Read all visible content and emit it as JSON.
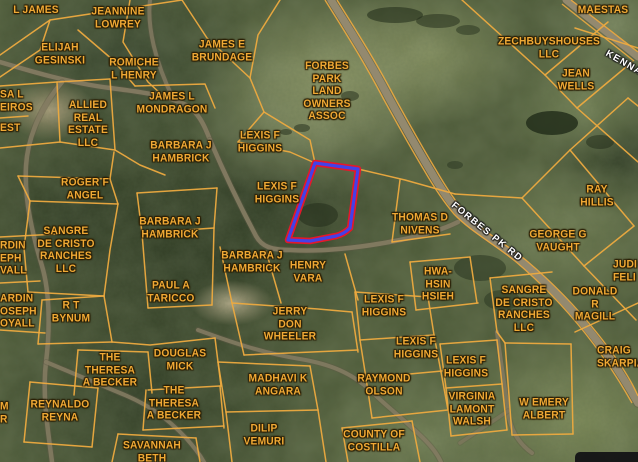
{
  "map": {
    "type": "county-parcel-satellite-map",
    "colors": {
      "parcel_line": "#edaa3f",
      "owner_label": "#f0a935",
      "road_label": "#ffffff",
      "selection_outer": "#e5182b",
      "selection_inner": "#4341e8",
      "main_road": "#93896f",
      "dirt_road": "#857c63"
    },
    "selected_parcel": {
      "path": "M315,163 L358,169 L350,228 Q344,234 336,236 L310,241 L288,240 Z",
      "outer_color": "#e5182b",
      "outer_width": 6.5,
      "inner_color": "#4341e8",
      "inner_width": 3.2
    },
    "parcel_labels": [
      {
        "id": "l-james",
        "t": "L JAMES",
        "x": 36,
        "y": 10
      },
      {
        "id": "jeannine-lowrey",
        "t": "JEANNINE\nLOWREY",
        "x": 118,
        "y": 18
      },
      {
        "id": "elijah-gesinski",
        "t": "ELIJAH\nGESINSKI",
        "x": 60,
        "y": 54
      },
      {
        "id": "romiche-l-henry",
        "t": "ROMICHE\nL HENRY",
        "x": 134,
        "y": 69
      },
      {
        "id": "james-e-brundage",
        "t": "JAMES E\nBRUNDAGE",
        "x": 222,
        "y": 51
      },
      {
        "id": "forbes-park-land-owners-assoc",
        "t": "FORBES\nPARK\nLAND\nOWNERS\nASSOC",
        "x": 327,
        "y": 91
      },
      {
        "id": "maestas",
        "t": "MAESTAS",
        "x": 603,
        "y": 10
      },
      {
        "id": "zechbuyshouses-llc",
        "t": "ZECHBUYSHOUSES\nLLC",
        "x": 549,
        "y": 48
      },
      {
        "id": "jean-wells",
        "t": "JEAN\nWELLS",
        "x": 576,
        "y": 80
      },
      {
        "id": "james-l-mondragon",
        "t": "JAMES L\nMONDRAGON",
        "x": 172,
        "y": 103
      },
      {
        "id": "allied-real-estate-llc",
        "t": "ALLIED\nREAL\nESTATE\nLLC",
        "x": 88,
        "y": 124
      },
      {
        "id": "fragment-sa-l-eiros",
        "t": "SA L\nEIROS",
        "x": 0,
        "y": 101,
        "a": "l"
      },
      {
        "id": "fragment-est",
        "t": "EST",
        "x": 0,
        "y": 128,
        "a": "l"
      },
      {
        "id": "barbara-j-hambrick-1",
        "t": "BARBARA J\nHAMBRICK",
        "x": 181,
        "y": 152
      },
      {
        "id": "lexis-f-higgins-1",
        "t": "LEXIS F\nHIGGINS",
        "x": 260,
        "y": 142
      },
      {
        "id": "lexis-f-higgins-2",
        "t": "LEXIS F\nHIGGINS",
        "x": 277,
        "y": 193
      },
      {
        "id": "roger-f-angel",
        "t": "ROGER F\nANGEL",
        "x": 85,
        "y": 189
      },
      {
        "id": "sangre-de-cristo-ranches-llc-1",
        "t": "SANGRE\nDE CRISTO\nRANCHES\nLLC",
        "x": 66,
        "y": 250
      },
      {
        "id": "barbara-j-hambrick-2",
        "t": "BARBARA J\nHAMBRICK",
        "x": 170,
        "y": 228
      },
      {
        "id": "paul-a-taricco",
        "t": "PAUL A\nTARICCO",
        "x": 171,
        "y": 292
      },
      {
        "id": "r-t-bynum",
        "t": "R T\nBYNUM",
        "x": 71,
        "y": 312
      },
      {
        "id": "fragment-rdin-eph-vall",
        "t": "RDIN\nEPH\nVALL",
        "x": 0,
        "y": 258,
        "a": "l"
      },
      {
        "id": "fragment-ardin-oseph-oyall",
        "t": "ARDIN\nOSEPH\nOYALL",
        "x": 0,
        "y": 311,
        "a": "l"
      },
      {
        "id": "thomas-d-nivens",
        "t": "THOMAS D\nNIVENS",
        "x": 420,
        "y": 224
      },
      {
        "id": "henry-vara",
        "t": "HENRY\nVARA",
        "x": 308,
        "y": 272
      },
      {
        "id": "barbara-j-hambrick-3",
        "t": "BARBARA J\nHAMBRICK",
        "x": 252,
        "y": 262
      },
      {
        "id": "hwa-hsin-hsieh",
        "t": "HWA-\nHSIN\nHSIEH",
        "x": 438,
        "y": 284
      },
      {
        "id": "ray-hillis",
        "t": "RAY\nHILLIS",
        "x": 597,
        "y": 196
      },
      {
        "id": "george-g-vaught",
        "t": "GEORGE G\nVAUGHT",
        "x": 558,
        "y": 241
      },
      {
        "id": "sangre-de-cristo-ranches-llc-2",
        "t": "SANGRE\nDE CRISTO\nRANCHES\nLLC",
        "x": 524,
        "y": 309
      },
      {
        "id": "donald-r-magill",
        "t": "DONALD R\nMAGILL",
        "x": 595,
        "y": 304
      },
      {
        "id": "fragment-judi-feli",
        "t": "JUDI\nFELI",
        "x": 613,
        "y": 271,
        "a": "l"
      },
      {
        "id": "craig-skarpia",
        "t": "CRAIG\nSKARPIA",
        "x": 597,
        "y": 357,
        "a": "l"
      },
      {
        "id": "jerry-don-wheeler",
        "t": "JERRY\nDON\nWHEELER",
        "x": 290,
        "y": 324
      },
      {
        "id": "lexis-f-higgins-3",
        "t": "LEXIS F\nHIGGINS",
        "x": 384,
        "y": 306
      },
      {
        "id": "lexis-f-higgins-4",
        "t": "LEXIS F\nHIGGINS",
        "x": 416,
        "y": 348
      },
      {
        "id": "madhavi-k-angara",
        "t": "MADHAVI K\nANGARA",
        "x": 278,
        "y": 385
      },
      {
        "id": "raymond-olson",
        "t": "RAYMOND\nOLSON",
        "x": 384,
        "y": 385
      },
      {
        "id": "dilip-vemuri",
        "t": "DILIP\nVEMURI",
        "x": 264,
        "y": 435
      },
      {
        "id": "county-of-costilla",
        "t": "COUNTY OF\nCOSTILLA",
        "x": 374,
        "y": 441
      },
      {
        "id": "the-theresa-a-becker-1",
        "t": "THE\nTHERESA\nA BECKER",
        "x": 110,
        "y": 370
      },
      {
        "id": "douglas-mick",
        "t": "DOUGLAS\nMICK",
        "x": 180,
        "y": 360
      },
      {
        "id": "the-theresa-a-becker-2",
        "t": "THE\nTHERESA\nA BECKER",
        "x": 174,
        "y": 403
      },
      {
        "id": "reynaldo-reyna",
        "t": "REYNALDO\nREYNA",
        "x": 60,
        "y": 411
      },
      {
        "id": "savannah-beth",
        "t": "SAVANNAH\nBETH",
        "x": 152,
        "y": 452
      },
      {
        "id": "lexis-f-higgins-5",
        "t": "LEXIS F\nHIGGINS",
        "x": 466,
        "y": 367
      },
      {
        "id": "virginia-lamont-walsh",
        "t": "VIRGINIA\nLAMONT\nWALSH",
        "x": 472,
        "y": 409
      },
      {
        "id": "w-emery-albert",
        "t": "W EMERY\nALBERT",
        "x": 544,
        "y": 409
      },
      {
        "id": "fragment-m-r",
        "t": "M\nR",
        "x": 0,
        "y": 413,
        "a": "l"
      }
    ],
    "road_labels": [
      {
        "id": "forbes-pk-rd",
        "t": "FORBES PK RD",
        "x": 487,
        "y": 232,
        "angle": 39
      },
      {
        "id": "kenna-rd",
        "t": "KENNA",
        "x": 624,
        "y": 63,
        "angle": 30
      }
    ],
    "roads": [
      {
        "d": "M331,0 C346,24 368,58 389,98 C405,127 416,147 430,170 C441,189 449,201 460,214 C476,231 500,244 521,261 C547,283 571,308 591,333 C611,358 625,380 638,403",
        "w": 7.5,
        "c": "#93896f",
        "o": 1
      },
      {
        "d": "M566,0 L638,57",
        "w": 7,
        "c": "#93896f",
        "o": 1
      },
      {
        "d": "M0,62 C30,71 70,83 110,88 C142,92 166,95 186,105 C198,112 204,124 210,140",
        "w": 4.5,
        "c": "#857c63",
        "o": 0.9
      },
      {
        "d": "M210,140 C222,168 240,206 256,236 C262,247 272,250 290,250 C320,252 360,248 400,240 C420,236 442,230 458,222",
        "w": 4.5,
        "c": "#857c63",
        "o": 0.9
      },
      {
        "d": "M62,82 C45,102 28,132 26,166 C24,200 33,236 42,266 C50,293 50,330 46,362 C42,396 48,430 52,462",
        "w": 4.5,
        "c": "#857c63",
        "o": 0.85
      },
      {
        "d": "M46,362 C72,373 96,383 120,393 C150,405 168,419 186,438 C194,447 200,455 204,462",
        "w": 4,
        "c": "#857c63",
        "o": 0.85
      },
      {
        "d": "M198,330 C228,341 262,353 300,359 C330,364 352,373 371,391 C386,406 406,421 424,439 C431,446 437,453 441,462",
        "w": 4,
        "c": "#857c63",
        "o": 0.85
      },
      {
        "d": "M497,332 C500,357 505,387 508,411 C510,429 518,443 532,453",
        "w": 4,
        "c": "#857c63",
        "o": 0.8
      },
      {
        "d": "M508,411 C492,422 476,432 460,443",
        "w": 3.5,
        "c": "#857c63",
        "o": 0.6
      },
      {
        "d": "M150,0 C147,26 155,62 173,98",
        "w": 4,
        "c": "#857c63",
        "o": 0.8
      }
    ],
    "road_casings": [
      {
        "d": "M325,0 C340,24 362,58 383,98 C399,127 410,147 424,170 C435,189 443,201 454,214 C470,231 494,244 515,261 C541,283 565,308 585,333 C605,358 619,380 632,403"
      },
      {
        "d": "M337,0 C352,24 374,58 395,98 C411,127 422,147 436,170 C447,189 455,201 466,214 C482,231 506,244 527,261 C553,283 577,308 597,333 C617,358 631,380 638,396"
      },
      {
        "d": "M562,4 L634,61"
      },
      {
        "d": "M571,0 L638,52"
      }
    ],
    "parcel_lines": [
      "0,55 50,20 182,0",
      "50,20 40,50 0,77",
      "78,30 113,60 135,86",
      "130,0 123,42 148,82 162,95",
      "182,0 207,38 250,78",
      "280,0 258,35 250,78",
      "250,78 264,112 238,142",
      "0,86 57,82 110,79",
      "57,82 60,142",
      "110,79 115,150",
      "0,148 60,142 115,150",
      "135,86 205,84 215,108",
      "115,150 140,165 165,175",
      "0,118 28,116",
      "238,142 290,152 315,163",
      "264,112 310,140 315,163",
      "358,169 405,180 455,194",
      "455,194 522,198",
      "137,193 217,188",
      "137,193 142,233",
      "217,188 214,228",
      "142,233 214,228",
      "18,176 110,179",
      "18,176 30,201",
      "30,201 118,204",
      "110,179 114,152",
      "110,179 118,204",
      "30,201 24,248 28,292",
      "28,292 104,296",
      "118,204 110,250 104,296",
      "142,233 148,308",
      "214,228 212,305",
      "148,308 212,305",
      "0,237 58,234",
      "0,283 40,281",
      "0,330 45,333",
      "42,300 104,296",
      "104,296 112,342",
      "42,300 38,344",
      "38,344 112,342",
      "112,342 150,345 215,338",
      "215,338 221,386",
      "78,350 148,352",
      "78,350 74,395",
      "148,352 152,393",
      "148,390 220,386",
      "220,386 224,428",
      "146,390 143,430",
      "143,430 224,426",
      "30,382 98,388",
      "30,382 24,442",
      "98,388 92,447",
      "24,442 92,447",
      "118,434 196,438",
      "118,434 112,462",
      "196,438 200,462",
      "220,247 232,303",
      "266,251 281,303",
      "345,254 358,300",
      "232,303 318,309 352,312",
      "232,303 244,355",
      "352,312 358,352",
      "244,355 358,350",
      "218,362 310,366",
      "218,362 226,412",
      "310,366 318,410",
      "226,412 318,410",
      "226,412 232,462",
      "318,410 326,462",
      "342,428 412,421",
      "342,428 348,462",
      "412,421 420,462",
      "355,292 428,297",
      "355,292 360,340",
      "428,297 434,335",
      "360,340 434,335",
      "360,340 366,378",
      "434,335 441,372",
      "366,378 442,371",
      "366,378 372,418",
      "441,372 448,410",
      "372,418 448,410",
      "400,180 392,242",
      "392,242 450,234",
      "410,262 470,257",
      "410,262 416,310",
      "470,257 477,303",
      "416,310 478,303",
      "440,344 497,340",
      "440,344 446,388",
      "497,340 502,384",
      "446,388 502,384",
      "446,388 451,436",
      "502,384 507,430",
      "451,436 507,430",
      "505,343 571,344",
      "505,343 512,435",
      "571,344 573,434",
      "512,435 573,434",
      "490,278 552,272",
      "490,278 497,332",
      "497,332 505,343",
      "522,198 570,150",
      "570,150 634,226",
      "522,198 584,266",
      "584,266 634,226",
      "584,266 636,320",
      "575,332 638,303",
      "570,150 628,98",
      "628,98 638,106",
      "462,0 545,75",
      "545,75 608,22",
      "545,75 577,108",
      "577,108 632,62",
      "577,108 638,162",
      "575,28 638,48"
    ],
    "forest_patches": [
      {
        "cx": 395,
        "cy": 15,
        "rx": 28,
        "ry": 8,
        "o": 0.55
      },
      {
        "cx": 438,
        "cy": 21,
        "rx": 22,
        "ry": 7,
        "o": 0.5
      },
      {
        "cx": 468,
        "cy": 30,
        "rx": 12,
        "ry": 5,
        "o": 0.45
      },
      {
        "cx": 350,
        "cy": 96,
        "rx": 9,
        "ry": 5,
        "o": 0.5
      },
      {
        "cx": 302,
        "cy": 128,
        "rx": 8,
        "ry": 4,
        "o": 0.5
      },
      {
        "cx": 286,
        "cy": 132,
        "rx": 6,
        "ry": 3,
        "o": 0.5
      },
      {
        "cx": 552,
        "cy": 123,
        "rx": 26,
        "ry": 12,
        "o": 0.8
      },
      {
        "cx": 600,
        "cy": 142,
        "rx": 14,
        "ry": 7,
        "o": 0.5
      },
      {
        "cx": 480,
        "cy": 268,
        "rx": 26,
        "ry": 13,
        "o": 0.45
      },
      {
        "cx": 502,
        "cy": 300,
        "rx": 18,
        "ry": 10,
        "o": 0.4
      },
      {
        "cx": 455,
        "cy": 165,
        "rx": 8,
        "ry": 4,
        "o": 0.4
      },
      {
        "cx": 318,
        "cy": 215,
        "rx": 20,
        "ry": 12,
        "o": 0.5
      }
    ],
    "overlay_box": {
      "present": true
    }
  }
}
